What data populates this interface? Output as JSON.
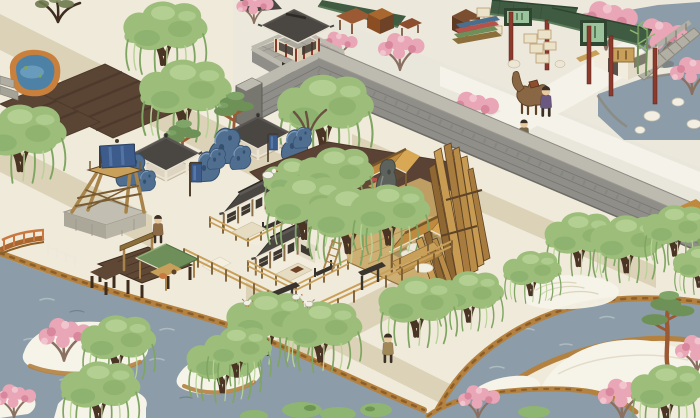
{
  "meta": {
    "title": "Isometric Jiangnan water-town scene (city-builder game view)"
  },
  "colors": {
    "base_ground": "#F0EADA",
    "market_ground": "#ECE8DC",
    "road_pale": "#E9E6DB",
    "path": "#DCD2B7",
    "path_light": "#F5F2E9",
    "water": "#8C9CA8",
    "wave_light": "#AEBAC1",
    "wave_dark": "#71848F",
    "pond_blue": "#4E81A6",
    "pond_blue_light": "#74A7C6",
    "pond_rim": "#C8803C",
    "bank": "#B5813E",
    "bank_dark": "#8B5E2A",
    "sand_white": "#F6F3E9",
    "sand_line": "#DCD5BD",
    "field": "#5A4434",
    "field_row": "#4C3A2B",
    "wall_face": "#8F8E88",
    "wall_course": "#6C6B66",
    "wall_cap": "#BDBAB0",
    "wall_dark": "#77766F",
    "brick_floor": "#ACAAA0",
    "brick_line": "#908E85",
    "roof_dark": "#4A4642",
    "roof_dark_hi": "#5D5955",
    "ridge_dark": "#2E2A26",
    "eave_cream": "#E9E2D1",
    "roof_tan": "#C08A3E",
    "roof_tan_hi": "#D9A855",
    "roof_tan_ridge": "#77572A",
    "roof_green": "#3F5B41",
    "roof_green_hi": "#5B7A59",
    "sign_green": "#9CC49C",
    "pillar_red": "#8B3A2C",
    "wood": "#A8834A",
    "wood_dark": "#7A5C32",
    "wood_light": "#C9A05A",
    "wood_deep": "#5E4734",
    "wood_edge": "#5E4326",
    "wall_white": "#F2ECDD",
    "wall_shade": "#E3DBC8",
    "window_dark": "#3E3832",
    "willow": "#9CBE7A",
    "willow_dark": "#7FA562",
    "willow_light": "#B7D295",
    "trunk": "#4A3424",
    "pine_green": "#6E9158",
    "pine_green_hi": "#7FA568",
    "pine_trunk": "#9B5A33",
    "blossom": "#E9A6B6",
    "blossom_dark": "#D9879C",
    "blossom_light": "#F2C4CE",
    "blossom_branch": "#8A7060",
    "rock_blue": "#4F6E90",
    "rock_blue_dark": "#35506E",
    "rock_blue_hi": "#7E9CBA",
    "rock_gray": "#5E625C",
    "rock_gray_dark": "#44483F",
    "rock_gray_hi": "#878B82",
    "stone": "#B2AFA4",
    "stone_dark": "#8B887C",
    "dirt": "#5A4234",
    "banner_blue": "#3D5C8C",
    "banner_blue_hi": "#5578A8",
    "camel": "#8A6744",
    "camel_dark": "#5E4328",
    "skin": "#E8C9A0",
    "bush": "#8FB572",
    "bush_dark": "#6E9552",
    "shelter_green": "#6E8E5A",
    "crate": "#EBE2CA",
    "crate_line": "#B99B6E",
    "fabric_blue": "#4A6E8E",
    "fabric_red": "#B5524A",
    "fabric_green": "#6E8E5A",
    "white_bird": "#F2EFE6",
    "person_merchant": "#6B5880",
    "person_market": "#77684A",
    "person_plaza": "#8B6A45",
    "person_south": "#A08858"
  },
  "scene": {
    "labels": {
      "viewport": "Game world viewport",
      "city_wall": "City wall",
      "gate_tower": "City gate tower",
      "wall_yard": "Walled brick yard",
      "market_district": "Market street outside the wall",
      "market_stall_1": "Goods stall with crates",
      "market_stall_2": "Cloth and goods stall",
      "furniture_stall": "Furniture stall",
      "teahouse": "White-walled shop with sign",
      "stone_bridge": "Stone arch bridge",
      "market_pond": "Rock pond",
      "camel": "Trade camel",
      "merchant": "Merchant",
      "market_walker": "Villager walking in market",
      "farm_plots": "Tilled farm plots",
      "west_pond": "Blue pond with earthen rim",
      "stone_wharf": "Stone wharf steps",
      "watchtower": "Wooden watchtower with blue flag",
      "pavilion_1": "Garden pavilion",
      "pavilion_2": "Garden pavilion",
      "blue_rock": "Blue scholar stone",
      "banner": "Blue banner",
      "compound": "Lumber-yard compound",
      "courtyard_house_1": "Courtyard house",
      "courtyard_house_2": "Courtyard house",
      "lumber_shed_1": "Open lumber shed",
      "lumber_shed_2": "Open lumber shed",
      "timber_stack": "Leaning timber stack",
      "scholar_rock": "Tall gray scholar rock",
      "sawing_station": "Plank sawing station",
      "ladder": "Wooden ladder",
      "baskets": "Woven baskets",
      "plaza_villager": "Villager near pavilion",
      "south_villager": "Villager on path",
      "goose": "White goose",
      "chicken": "Chicken",
      "lake": "Lake",
      "river": "Winding river",
      "island": "Sandbar island",
      "pier": "Wooden pier",
      "fish_shelter": "Green-roofed pier shelter",
      "pier_frame": "Wooden sign frame",
      "orange_bridge": "Orange-railed footbridge",
      "white_fence": "White fence",
      "zen_sand": "Raked sand patch",
      "sand_mound": "White sand mound",
      "willow": "Willow tree",
      "pine": "Pine tree",
      "plum": "Plum blossom tree",
      "bare_tree": "Bare tree",
      "bush": "Green bush",
      "bamboo": "Bamboo"
    },
    "counts": {
      "willow_trees": 22,
      "pine_trees": 3,
      "blossom_trees": 10,
      "pavilions": 2,
      "courtyard_houses": 2,
      "market_stalls": 3,
      "chickens": 3,
      "villagers": 4
    }
  }
}
